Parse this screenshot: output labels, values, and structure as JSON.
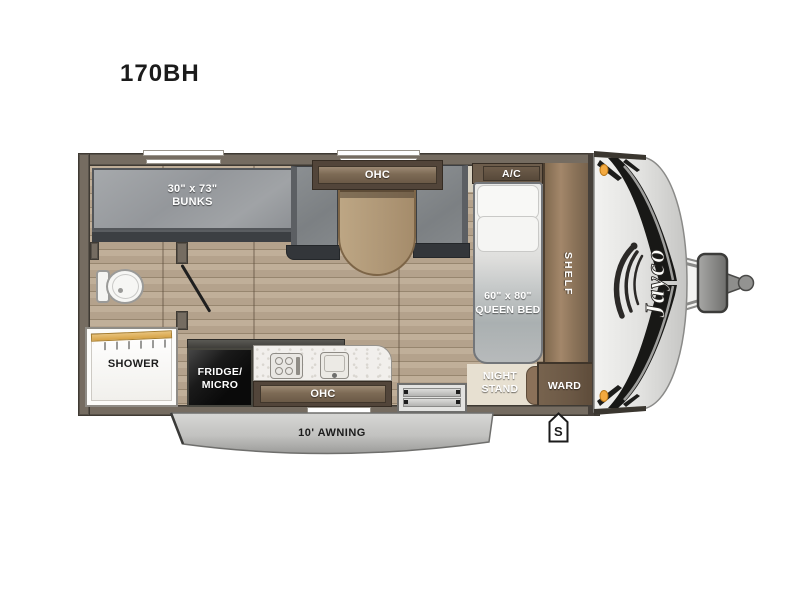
{
  "title": "170BH",
  "floorplan": {
    "bunks_dim": "30\" x 73\"",
    "bunks_label": "BUNKS",
    "dinette_ohc_label": "OHC",
    "ac_label": "A/C",
    "shelf_label": "SHELF",
    "bed_dim": "60\" x 80\"",
    "bed_label": "QUEEN BED",
    "night_stand_line1": "NIGHT",
    "night_stand_line2": "STAND",
    "ward_label": "WARD",
    "shower_label": "SHOWER",
    "fridge_line1": "FRIDGE/",
    "fridge_line2": "MICRO",
    "kitchen_ohc_label": "OHC",
    "awning_label": "10' AWNING",
    "spare_tire_marker": "S",
    "brand": "Jayco"
  },
  "colors": {
    "wall": "#756c61",
    "floor_wood": "#b5a38d",
    "mattress_gray": "#9b9ea2",
    "cabinet_brown": "#7d6a55",
    "shelf_wood": "#8b7359",
    "awning_silver": "#c6c6c4",
    "marker_amber": "#f3a93f",
    "fridge_black": "#0e0e0e"
  }
}
